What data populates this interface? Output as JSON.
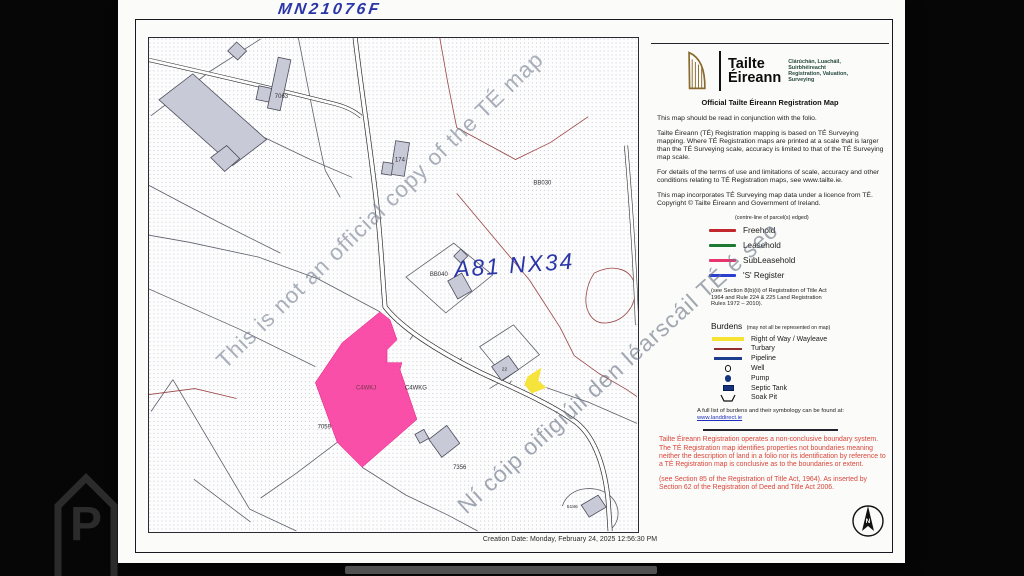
{
  "scan": {
    "folio_handwritten": "MN21076F",
    "map_handwritten": "A81 NX34",
    "photo_watermark_letter": "P"
  },
  "header": {
    "brand_line1": "Tailte",
    "brand_line2": "Éireann",
    "tagline": [
      "Clárúchán, Luacháil,",
      "Suirbhéireacht",
      "Registration, Valuation,",
      "Surveying"
    ],
    "title": "Official Tailte Éireann Registration Map"
  },
  "notes": [
    "This map should be read in conjunction with the folio.",
    "Tailte Éireann (TÉ) Registration mapping is based on TÉ Surveying mapping. Where TÉ Registration maps are printed at a scale that is larger than the TÉ Surveying scale, accuracy is limited to that of the TÉ Surveying map scale.",
    "For details of the terms of use and limitations of scale, accuracy and other conditions relating to TÉ Registration maps, see www.tailte.ie.",
    "This map incorporates TÉ Surveying map data under a licence from TÉ. Copyright © Tailte Éireann and Government of Ireland."
  ],
  "legend": {
    "heading": "(centre-line of parcel(s) edged)",
    "items": [
      {
        "label": "Freehold",
        "color": "#c1272d"
      },
      {
        "label": "Leasehold",
        "color": "#1e7a33"
      },
      {
        "label": "SubLeasehold",
        "color": "#e8356d"
      },
      {
        "label": "'S' Register",
        "color": "#2b3fd1"
      }
    ],
    "footnote": "(see Section 8(b)(ii) of Registration of Title Act 1964 and Rule 224 & 225 Land Registration Rules 1972 – 2010)."
  },
  "burdens": {
    "title": "Burdens",
    "title_note": "(may not all be represented on map)",
    "items": [
      {
        "label": "Right of Way / Wayleave",
        "symbol": "yellow-bar"
      },
      {
        "label": "Turbary",
        "symbol": "red-line"
      },
      {
        "label": "Pipeline",
        "symbol": "navy-line"
      },
      {
        "label": "Well",
        "symbol": "circle-outline"
      },
      {
        "label": "Pump",
        "symbol": "filled-dot"
      },
      {
        "label": "Septic Tank",
        "symbol": "navy-rect"
      },
      {
        "label": "Soak Pit",
        "symbol": "trough"
      }
    ],
    "footnote_text": "A full list of burdens and their symbology can be found at:",
    "footnote_link": "www.landdirect.ie"
  },
  "warning": {
    "para1": "Tailte Éireann Registration operates a non-conclusive boundary system. The TÉ Registration map identifies properties not boundaries meaning neither the description of land in a folio nor its identification by reference to a TÉ Registration map is conclusive as to the boundaries or extent.",
    "para2": "(see Section 85 of the Registration of Title Act, 1964). As inserted by Section 62 of the Registration of Deed and Title Act 2006."
  },
  "map": {
    "creation_date": "Creation Date: Monday, February 24, 2025 12:56:30 PM",
    "watermark_en": "This is not an official copy of the TÉ map",
    "watermark_ga": "Ní cóip oifigiúil den léarscáil TÉ é seo",
    "labels": [
      "7063",
      "174",
      "BB030",
      "BB040",
      "C4WKJ",
      "C4WKG",
      "7059",
      "7356",
      "22",
      "5186"
    ],
    "north_label": "N"
  },
  "colors": {
    "parcel_highlight": "#fa3c9e",
    "right_of_way_yellow": "#f6e231",
    "freehold_red": "#c1272d",
    "leasehold_green": "#1e7a33",
    "subleasehold_pink": "#e8356d",
    "s_register_blue": "#2b3fd1",
    "warning_red": "#d9463c",
    "ink_blue": "#2a35a8",
    "harp_gold": "#8a6b2d",
    "building_grey": "#c8cad7"
  }
}
